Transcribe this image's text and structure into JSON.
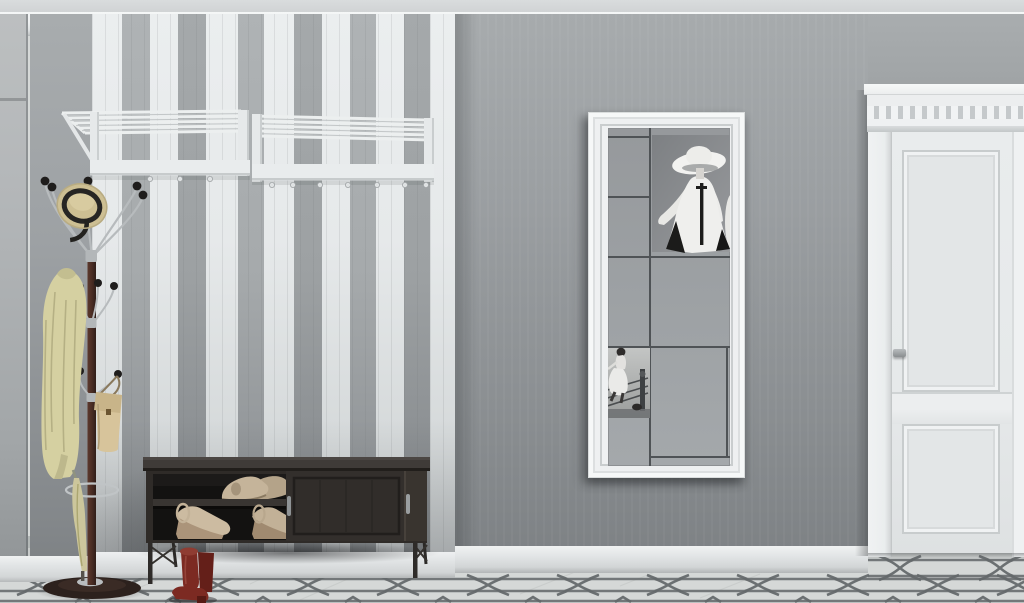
{
  "scene": {
    "type": "3d interior render",
    "room": "hallway entryway",
    "description": "Grey hallway with a white-and-grey striped panel wall, two white wall-mounted hat racks, a coat stand holding a straw hat, pale yellow coat, beige handbag and umbrella, a dark sliding-door shoe bench with beige shoes inside, red heeled ankle boots on the floor, a tall white-framed mirror reflecting fashion artwork, a white paneled door with dentil cornice, and a light tile floor with a grey chain pattern.",
    "palette": {
      "ceiling": "#d5d8d9",
      "molding": "#eff1f2",
      "wall_grey": "#9a9ea1",
      "wall_grey_dark": "#83878a",
      "stripe_white": "#e7eaeb",
      "stripe_grey": "#a6aaac",
      "mirror_frame": "#f0f2f3",
      "mirror_glass": "#9da1a4",
      "panel_grid": "#4f5356",
      "poster_grey": "#85888b",
      "figure_white": "#efefed",
      "door_white": "#e8ebec",
      "baseboard": "#e3e6e7",
      "floor": "#d6d9d8",
      "floor_pattern": "#6a6f71",
      "bench": "#302c29",
      "bench_interior": "#141312",
      "handle_silver": "#95999b",
      "shoe_beige": "#c6b59b",
      "wedge_cork": "#ab947a",
      "boot_red": "#7c2a22",
      "coat_yellow": "#d5d0a1",
      "hat_straw": "#d2c59b",
      "hat_band": "#262523",
      "bag_beige": "#d7c49b",
      "pole_brown": "#4d2f27",
      "chrome": "#b7bbbd",
      "knob_black": "#1f1d1c"
    },
    "ceiling_molding": {
      "label": "white crown molding along ceiling"
    },
    "striped_wall": {
      "label": "white and grey striped panel wall",
      "first_stripe": "white",
      "stripe_widths": [
        30,
        28,
        28,
        28,
        32,
        26,
        30,
        28,
        28,
        26,
        28,
        26,
        25
      ]
    },
    "wall_racks": {
      "label": "two white wall-mounted hat racks with rails and knob hooks",
      "count": 2,
      "hook_xs_left": [
        150,
        180,
        210
      ],
      "hook_xs_right": [
        272,
        293,
        320,
        348,
        377,
        405,
        426
      ]
    },
    "coat_stand": {
      "label": "dark wood coat stand with chrome arms and black ball hooks",
      "items": [
        "straw hat with black band",
        "pale yellow coat",
        "beige handbag",
        "folded umbrella in ring holder"
      ]
    },
    "shoe_bench": {
      "label": "dark sliding-door shoe bench on metal legs",
      "contents": [
        "beige platform pumps on upper shelf",
        "beige wedge sandals on lower shelf"
      ],
      "handles": 2
    },
    "red_boots": {
      "label": "red heeled ankle boots on the floor"
    },
    "mirror": {
      "label": "tall white-framed wall mirror",
      "reflections": [
        "panel grid of opposite wall",
        "poster of woman in wide-brim white hat and white coat-dress with black trim",
        "black-and-white photo of woman in white dress climbing into a boxing ring"
      ]
    },
    "door": {
      "label": "white two-panel door with dentil cornice pediment",
      "handle": "small silver lever"
    },
    "floor": {
      "label": "light marble tile floor with grey interlocking chain pattern",
      "link_xs": [
        38,
        128,
        218,
        308,
        398,
        488,
        578,
        668,
        758,
        848,
        938,
        1018
      ],
      "link_xs_right": [
        900,
        1000
      ]
    }
  }
}
